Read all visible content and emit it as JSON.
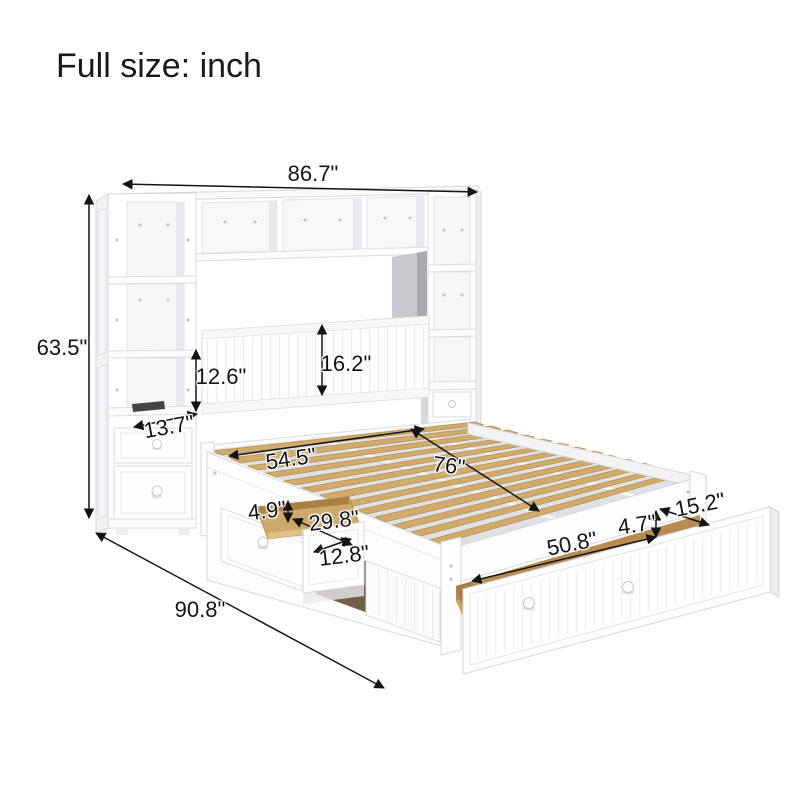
{
  "title": "Full size: inch",
  "unit": "inch",
  "dimensions": {
    "overall_width": "86.7\"",
    "overall_height": "63.5\"",
    "side_shelf_opening_height": "12.6\"",
    "headboard_panel_height": "16.2\"",
    "tower_depth": "13.7\"",
    "bed_width": "54.5\"",
    "bed_length": "76\"",
    "side_drawer_height": "4.9\"",
    "side_drawer_depth": "29.8\"",
    "side_drawer_width": "12.8\"",
    "trundle_drawer_depth": "15.2\"",
    "trundle_drawer_height": "4.7\"",
    "trundle_drawer_width": "50.8\"",
    "overall_depth": "90.8\""
  }
}
